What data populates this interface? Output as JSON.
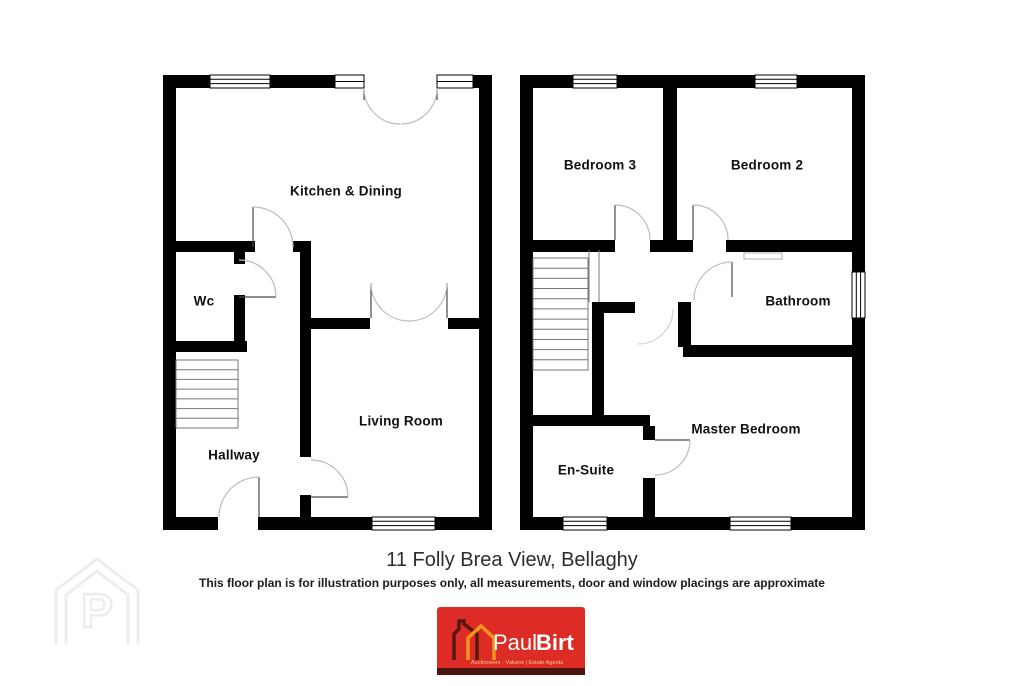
{
  "page": {
    "title": "11 Folly Brea View, Bellaghy",
    "disclaimer": "This floor plan is for illustration purposes only, all measurements, door and window placings are approximate"
  },
  "floor_plans": {
    "ground_floor": {
      "rooms": {
        "kitchen_dining": "Kitchen & Dining",
        "wc": "Wc",
        "living_room": "Living Room",
        "hallway": "Hallway"
      }
    },
    "first_floor": {
      "rooms": {
        "bedroom3": "Bedroom 3",
        "bedroom2": "Bedroom 2",
        "bathroom": "Bathroom",
        "master_bedroom": "Master Bedroom",
        "ensuite": "En-Suite"
      }
    }
  },
  "watermark": {
    "letter": "P"
  },
  "logo": {
    "brand_first": "Paul",
    "brand_second": "Birt",
    "tagline": "Auctioneers · Valuers | Estate Agents",
    "colors": {
      "background": "#dd2b26",
      "footer_strip": "#4a1410",
      "house_dark": "#5a1710",
      "house_orange": "#f0941e",
      "brand_text": "#ffffff",
      "tagline_text": "#f0cd8a"
    }
  },
  "drawing_colors": {
    "wall": "#000000",
    "door_arc": "#bcbcbc",
    "door_leaf": "#4a4a4a",
    "stair_line": "#777777"
  }
}
